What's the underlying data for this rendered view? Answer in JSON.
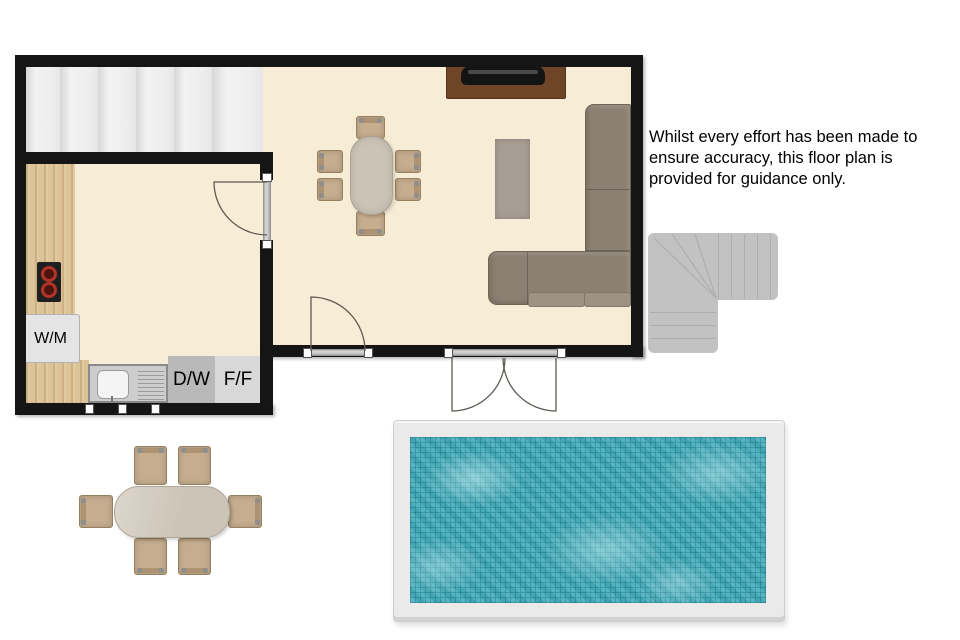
{
  "disclaimer": {
    "line1": "Whilst every effort has been made to",
    "line2": "ensure accuracy, this floor plan is",
    "line3": "provided for guidance only."
  },
  "labels": {
    "washing_machine": "W/M",
    "dishwasher": "D/W",
    "fridge_freezer": "F/F"
  },
  "colors": {
    "wall": "#151515",
    "floor": "#f7edd7",
    "wood_counter": "#dcc398",
    "pool_water": "#4aafbd",
    "pool_frame": "#eaeaea",
    "sofa": "#8b8172",
    "chair": "#c5ad8e",
    "table": "#cbc3b5",
    "rug": "#a79e93",
    "tv_cabinet": "#6e4526",
    "exterior_stairs": "#c2c2c2",
    "interior_stairs": "#ededed",
    "hob_burner": "#b23327"
  },
  "objects": [
    "internal-staircase",
    "kitchen-hob",
    "washing-machine",
    "sink-with-drainer",
    "dishwasher",
    "fridge-freezer",
    "kitchen-window",
    "single-door",
    "double-doors",
    "kitchen-door",
    "dining-table-with-6-chairs",
    "tv-on-cabinet",
    "rug",
    "l-shaped-sofa",
    "external-staircase",
    "swimming-pool",
    "outdoor-dining-table-with-6-chairs"
  ]
}
